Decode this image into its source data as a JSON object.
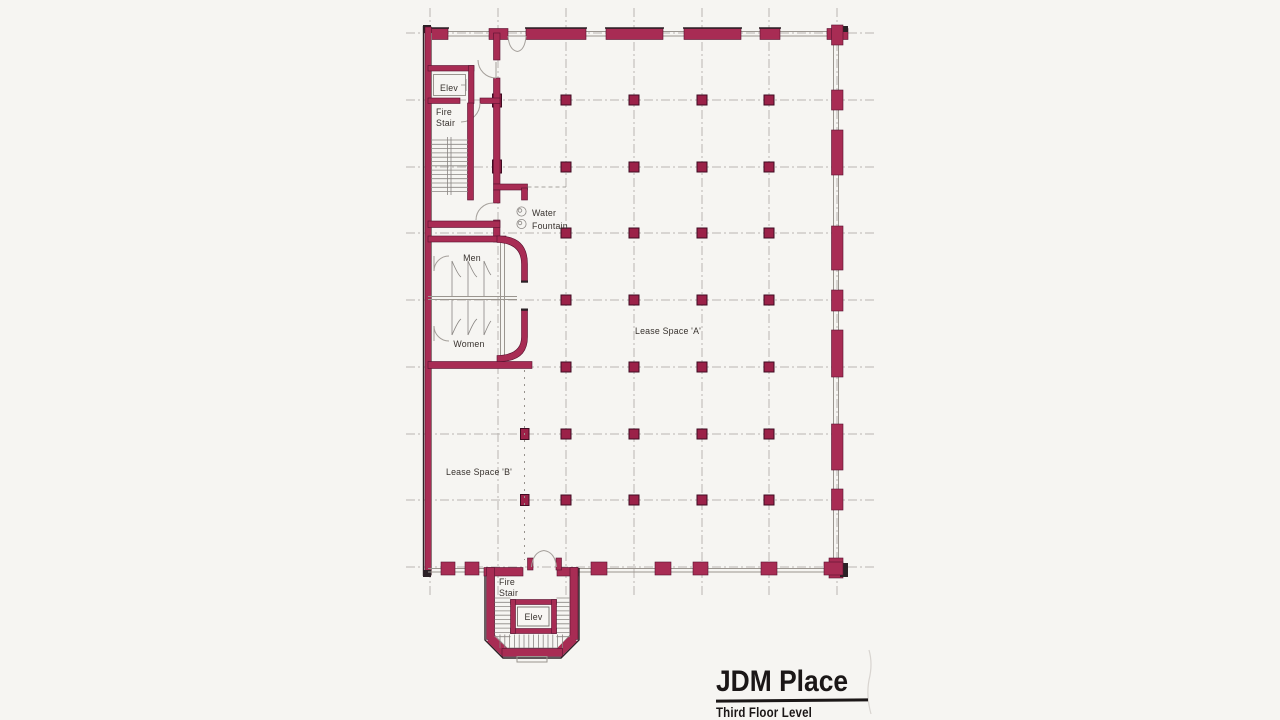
{
  "title_block": {
    "title": "JDM Place",
    "subtitle": "Third Floor Level"
  },
  "rooms": {
    "elevator_top": "Elev",
    "fire_stair_top": [
      "Fire",
      "Stair"
    ],
    "water_fountain": [
      "Water",
      "Fountain"
    ],
    "mens_restroom": "Men",
    "womens_restroom": "Women",
    "lease_space_a": "Lease Space 'A'",
    "lease_space_b": "Lease Space 'B'",
    "fire_stair_bottom": [
      "Fire",
      "Stair"
    ],
    "elevator_bottom": "Elev"
  },
  "colors": {
    "wall_accent": "#a82c54",
    "column": "#9b2148",
    "wall_edge": "#2b2126",
    "grid_line": "#b9b5b1",
    "paper": "#f6f5f2",
    "ink": "#38322e",
    "title_ink": "#1b1717"
  }
}
